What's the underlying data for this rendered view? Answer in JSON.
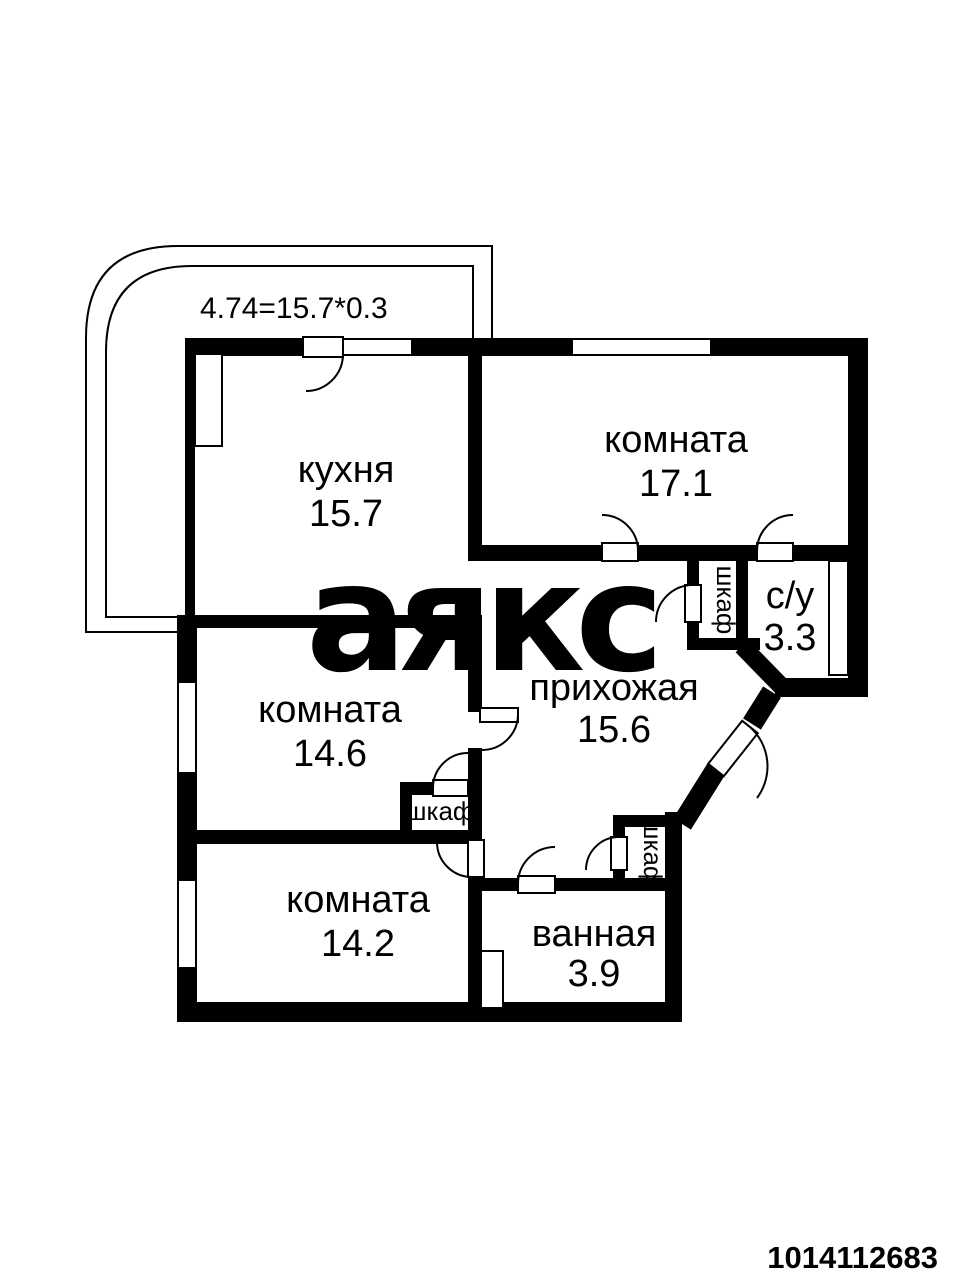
{
  "annotation": "4.74=15.7*0.3",
  "watermark": "аякс",
  "photo_id": "1014112683",
  "colors": {
    "wall": "#000000",
    "background": "#ffffff",
    "watermark_gray": "#e5e5e5",
    "id_red": "#d01d1d"
  },
  "rooms": {
    "kitchen": {
      "name": "кухня",
      "area": "15.7"
    },
    "room_17": {
      "name": "комната",
      "area": "17.1"
    },
    "room_146": {
      "name": "комната",
      "area": "14.6"
    },
    "room_142": {
      "name": "комната",
      "area": "14.2"
    },
    "hallway": {
      "name": "прихожая",
      "area": "15.6"
    },
    "bathroom": {
      "name": "ванная",
      "area": "3.9"
    },
    "wc": {
      "name": "с/у",
      "area": "3.3"
    }
  },
  "closets": {
    "closet_near_wc": {
      "label": "шкаф"
    },
    "closet_room_146": {
      "label": "шкаф"
    },
    "closet_near_bathroom": {
      "label": "шкаф"
    }
  }
}
